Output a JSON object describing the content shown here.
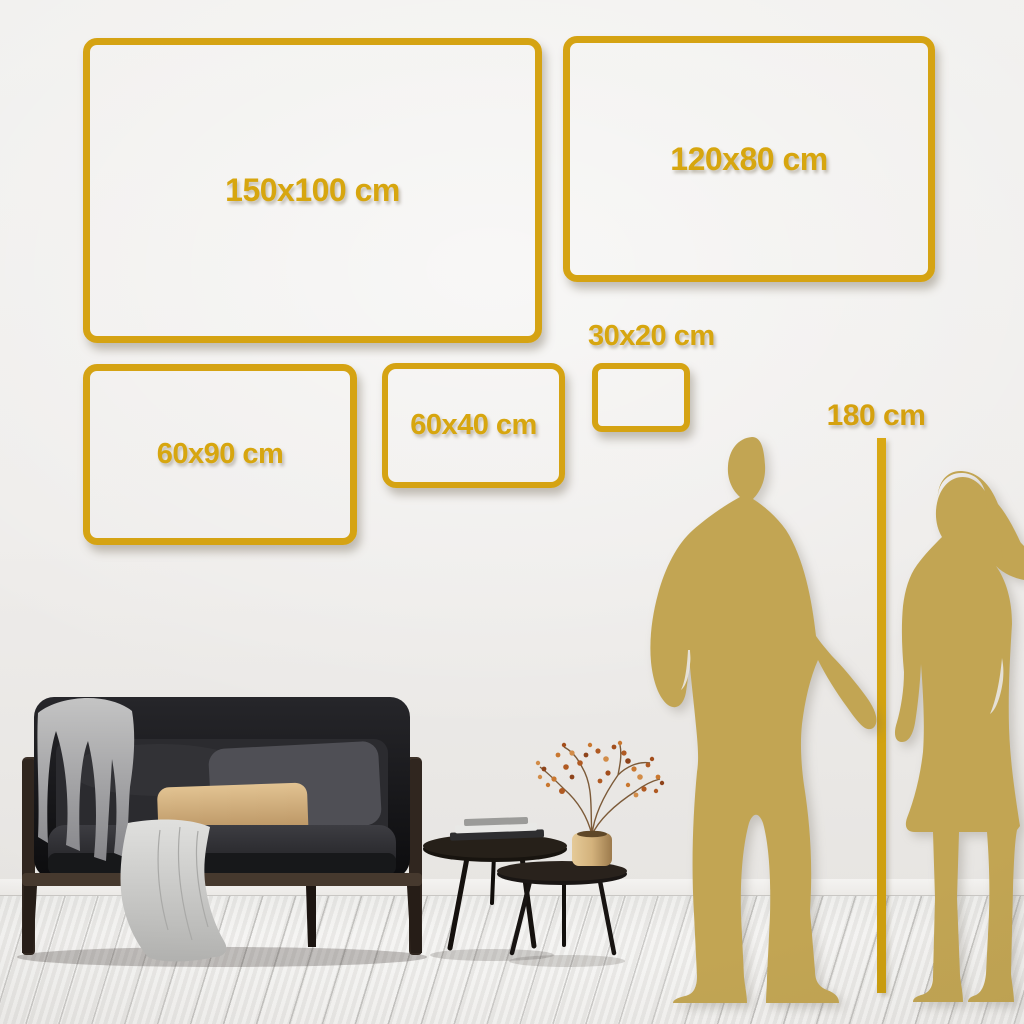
{
  "size_guide": {
    "frames": [
      {
        "id": "150x100",
        "label": "150x100 cm"
      },
      {
        "id": "120x80",
        "label": "120x80 cm"
      },
      {
        "id": "60x90",
        "label": "60x90 cm"
      },
      {
        "id": "60x40",
        "label": "60x40 cm"
      },
      {
        "id": "30x20",
        "label": "30x20 cm"
      }
    ],
    "height_marker": {
      "label": "180 cm"
    }
  },
  "colors": {
    "accent_gold": "#d5a313",
    "silhouette_gold": "#c2a553",
    "wall": "#efedeb",
    "floor": "#f2f1ef",
    "sofa_dark": "#141416",
    "pillow_tan": "#d2ae7f"
  }
}
